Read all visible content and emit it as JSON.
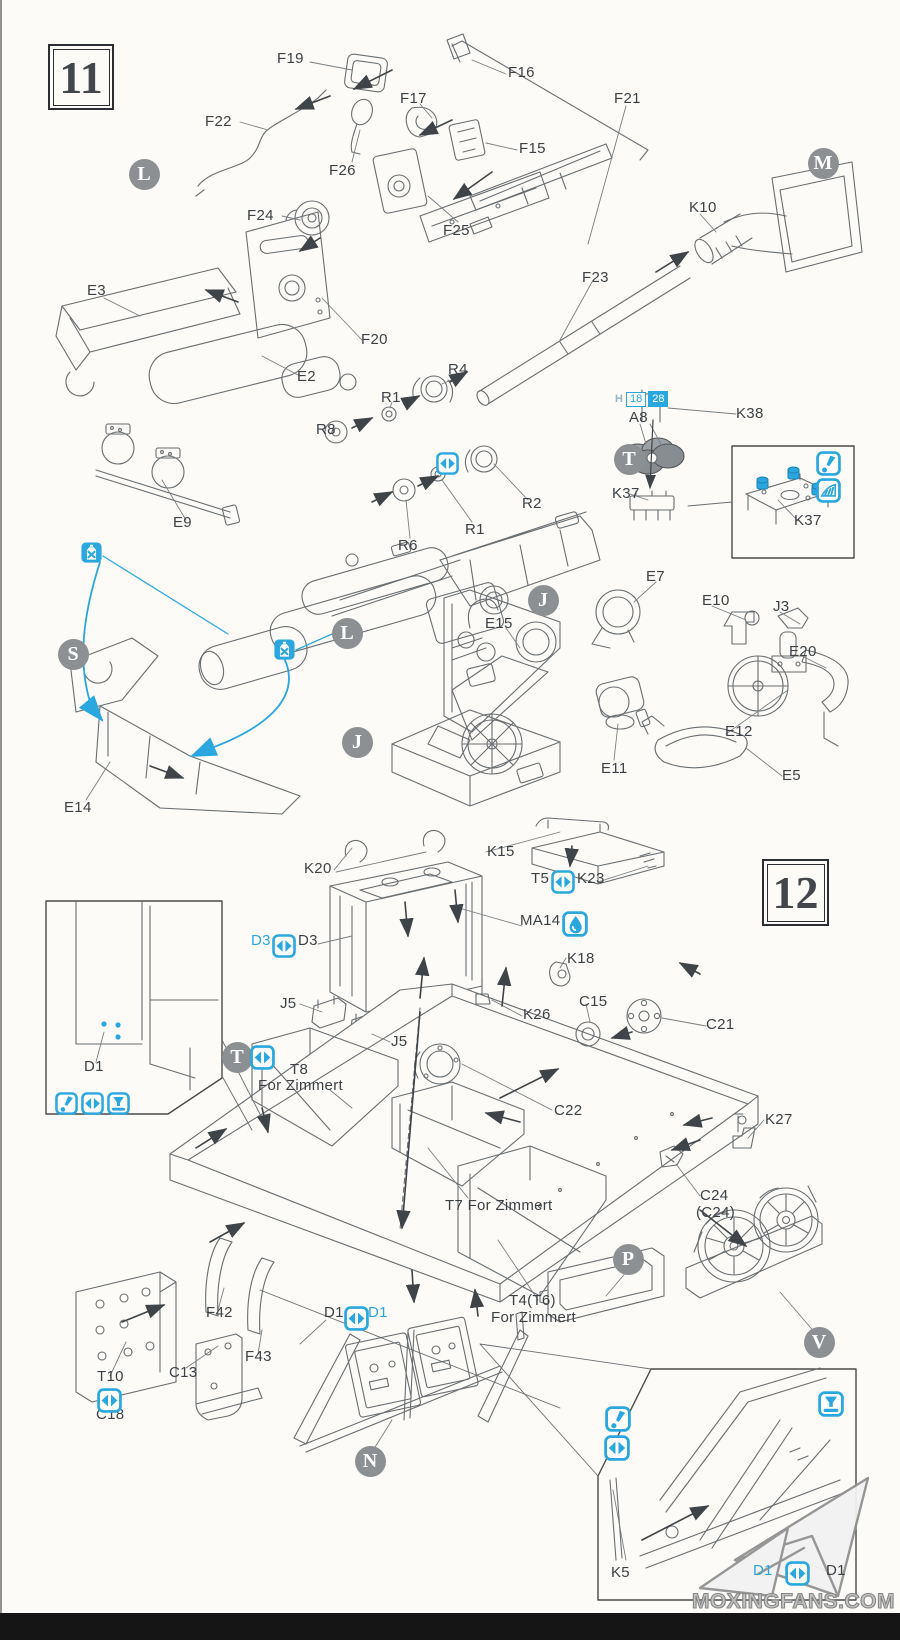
{
  "title": "Model kit assembly instructions, steps 11 and 12",
  "steps": [
    {
      "number": "11"
    },
    {
      "number": "12"
    }
  ],
  "colors": {
    "accent": "#2aa7df",
    "line": "#696e72",
    "label": "#3d4247",
    "badge": "#8d9093"
  },
  "paint_callout": {
    "prefix": "H",
    "left": "18",
    "right": "28"
  },
  "watermark": {
    "text": "MOXINGFANS.COM",
    "logo": "paper-plane-logo"
  },
  "part_labels": [
    {
      "t": "F19",
      "x": 277,
      "y": 51
    },
    {
      "t": "F16",
      "x": 508,
      "y": 65
    },
    {
      "t": "F17",
      "x": 400,
      "y": 91
    },
    {
      "t": "F21",
      "x": 614,
      "y": 91
    },
    {
      "t": "F22",
      "x": 205,
      "y": 114
    },
    {
      "t": "F26",
      "x": 329,
      "y": 163
    },
    {
      "t": "F15",
      "x": 519,
      "y": 141
    },
    {
      "t": "F25",
      "x": 443,
      "y": 223
    },
    {
      "t": "F24",
      "x": 247,
      "y": 208
    },
    {
      "t": "K10",
      "x": 689,
      "y": 200
    },
    {
      "t": "F23",
      "x": 582,
      "y": 270
    },
    {
      "t": "E3",
      "x": 87,
      "y": 283
    },
    {
      "t": "F20",
      "x": 361,
      "y": 332
    },
    {
      "t": "E2",
      "x": 297,
      "y": 369
    },
    {
      "t": "R4",
      "x": 448,
      "y": 362
    },
    {
      "t": "R1",
      "x": 381,
      "y": 390
    },
    {
      "t": "R8",
      "x": 316,
      "y": 422
    },
    {
      "t": "R2",
      "x": 522,
      "y": 496
    },
    {
      "t": "R1",
      "x": 465,
      "y": 522
    },
    {
      "t": "R6",
      "x": 398,
      "y": 538
    },
    {
      "t": "A8",
      "x": 629,
      "y": 410
    },
    {
      "t": "K38",
      "x": 736,
      "y": 406
    },
    {
      "t": "K37",
      "x": 612,
      "y": 486
    },
    {
      "t": "K37",
      "x": 794,
      "y": 513
    },
    {
      "t": "E9",
      "x": 173,
      "y": 515
    },
    {
      "t": "E14",
      "x": 64,
      "y": 800
    },
    {
      "t": "E15",
      "x": 485,
      "y": 616
    },
    {
      "t": "E7",
      "x": 646,
      "y": 569
    },
    {
      "t": "E10",
      "x": 702,
      "y": 593
    },
    {
      "t": "J3",
      "x": 773,
      "y": 599
    },
    {
      "t": "E20",
      "x": 789,
      "y": 644
    },
    {
      "t": "E12",
      "x": 725,
      "y": 724
    },
    {
      "t": "E11",
      "x": 601,
      "y": 761
    },
    {
      "t": "E5",
      "x": 782,
      "y": 768
    },
    {
      "t": "K15",
      "x": 487,
      "y": 844
    },
    {
      "t": "K20",
      "x": 304,
      "y": 861
    },
    {
      "t": "T5",
      "x": 531,
      "y": 871
    },
    {
      "t": "K23",
      "x": 577,
      "y": 871
    },
    {
      "t": "MA14",
      "x": 520,
      "y": 913
    },
    {
      "t": "D3",
      "x": 251,
      "y": 933,
      "c": 1
    },
    {
      "t": "D3",
      "x": 298,
      "y": 933
    },
    {
      "t": "K18",
      "x": 567,
      "y": 951
    },
    {
      "t": "J5",
      "x": 280,
      "y": 996
    },
    {
      "t": "J5",
      "x": 391,
      "y": 1034
    },
    {
      "t": "C15",
      "x": 579,
      "y": 994
    },
    {
      "t": "K26",
      "x": 523,
      "y": 1007
    },
    {
      "t": "C21",
      "x": 706,
      "y": 1017
    },
    {
      "t": "C22",
      "x": 554,
      "y": 1103
    },
    {
      "t": "K27",
      "x": 765,
      "y": 1112
    },
    {
      "t": "C24",
      "x": 700,
      "y": 1188
    },
    {
      "t": "(C24)",
      "x": 696,
      "y": 1205
    },
    {
      "t": "T8",
      "x": 290,
      "y": 1062
    },
    {
      "t": "For Zimmert",
      "x": 258,
      "y": 1078
    },
    {
      "t": "T7 For Zimmert",
      "x": 445,
      "y": 1198
    },
    {
      "t": "T4(T6)",
      "x": 509,
      "y": 1293
    },
    {
      "t": "For Zimmert",
      "x": 491,
      "y": 1310
    },
    {
      "t": "D1",
      "x": 84,
      "y": 1059
    },
    {
      "t": "F42",
      "x": 206,
      "y": 1305
    },
    {
      "t": "F43",
      "x": 245,
      "y": 1349
    },
    {
      "t": "C13",
      "x": 169,
      "y": 1365
    },
    {
      "t": "T10",
      "x": 97,
      "y": 1369
    },
    {
      "t": "C18",
      "x": 96,
      "y": 1407
    },
    {
      "t": "D1",
      "x": 324,
      "y": 1305
    },
    {
      "t": "D1",
      "x": 368,
      "y": 1305,
      "c": 1
    },
    {
      "t": "K5",
      "x": 611,
      "y": 1565
    },
    {
      "t": "D1",
      "x": 753,
      "y": 1563,
      "c": 1
    },
    {
      "t": "D1",
      "x": 826,
      "y": 1563
    }
  ],
  "assembly_letters": [
    {
      "t": "L",
      "x": 144,
      "y": 174
    },
    {
      "t": "M",
      "x": 823,
      "y": 163
    },
    {
      "t": "T",
      "x": 629,
      "y": 459
    },
    {
      "t": "S",
      "x": 73,
      "y": 654
    },
    {
      "t": "L",
      "x": 347,
      "y": 633
    },
    {
      "t": "J",
      "x": 357,
      "y": 742
    },
    {
      "t": "J",
      "x": 543,
      "y": 600
    },
    {
      "t": "T",
      "x": 237,
      "y": 1057
    },
    {
      "t": "P",
      "x": 628,
      "y": 1259
    },
    {
      "t": "V",
      "x": 819,
      "y": 1342
    },
    {
      "t": "N",
      "x": 370,
      "y": 1461
    }
  ],
  "icons": [
    {
      "type": "noglue",
      "x": 81,
      "y": 542,
      "s": 21
    },
    {
      "type": "noglue",
      "x": 274,
      "y": 639,
      "s": 21
    },
    {
      "type": "swap",
      "x": 436,
      "y": 452,
      "s": 23
    },
    {
      "type": "excl",
      "x": 816,
      "y": 451,
      "s": 25
    },
    {
      "type": "trim",
      "x": 816,
      "y": 478,
      "s": 25
    },
    {
      "type": "swap",
      "x": 551,
      "y": 870,
      "s": 24
    },
    {
      "type": "glue",
      "x": 562,
      "y": 911,
      "s": 26
    },
    {
      "type": "swap",
      "x": 272,
      "y": 934,
      "s": 24
    },
    {
      "type": "swap",
      "x": 250,
      "y": 1045,
      "s": 25
    },
    {
      "type": "excl",
      "x": 55,
      "y": 1092,
      "s": 23
    },
    {
      "type": "swap",
      "x": 81,
      "y": 1092,
      "s": 23
    },
    {
      "type": "drill",
      "x": 107,
      "y": 1092,
      "s": 23
    },
    {
      "type": "swap",
      "x": 97,
      "y": 1388,
      "s": 25
    },
    {
      "type": "swap",
      "x": 344,
      "y": 1306,
      "s": 25
    },
    {
      "type": "excl",
      "x": 605,
      "y": 1406,
      "s": 26
    },
    {
      "type": "swap",
      "x": 604,
      "y": 1435,
      "s": 26
    },
    {
      "type": "drill",
      "x": 818,
      "y": 1391,
      "s": 26
    },
    {
      "type": "swap",
      "x": 785,
      "y": 1561,
      "s": 25
    }
  ],
  "icon_legend": {
    "swap": "either-or choice",
    "noglue": "do not cement",
    "glue": "apply cement",
    "excl": "pay attention",
    "drill": "open hole",
    "trim": "shave off"
  }
}
